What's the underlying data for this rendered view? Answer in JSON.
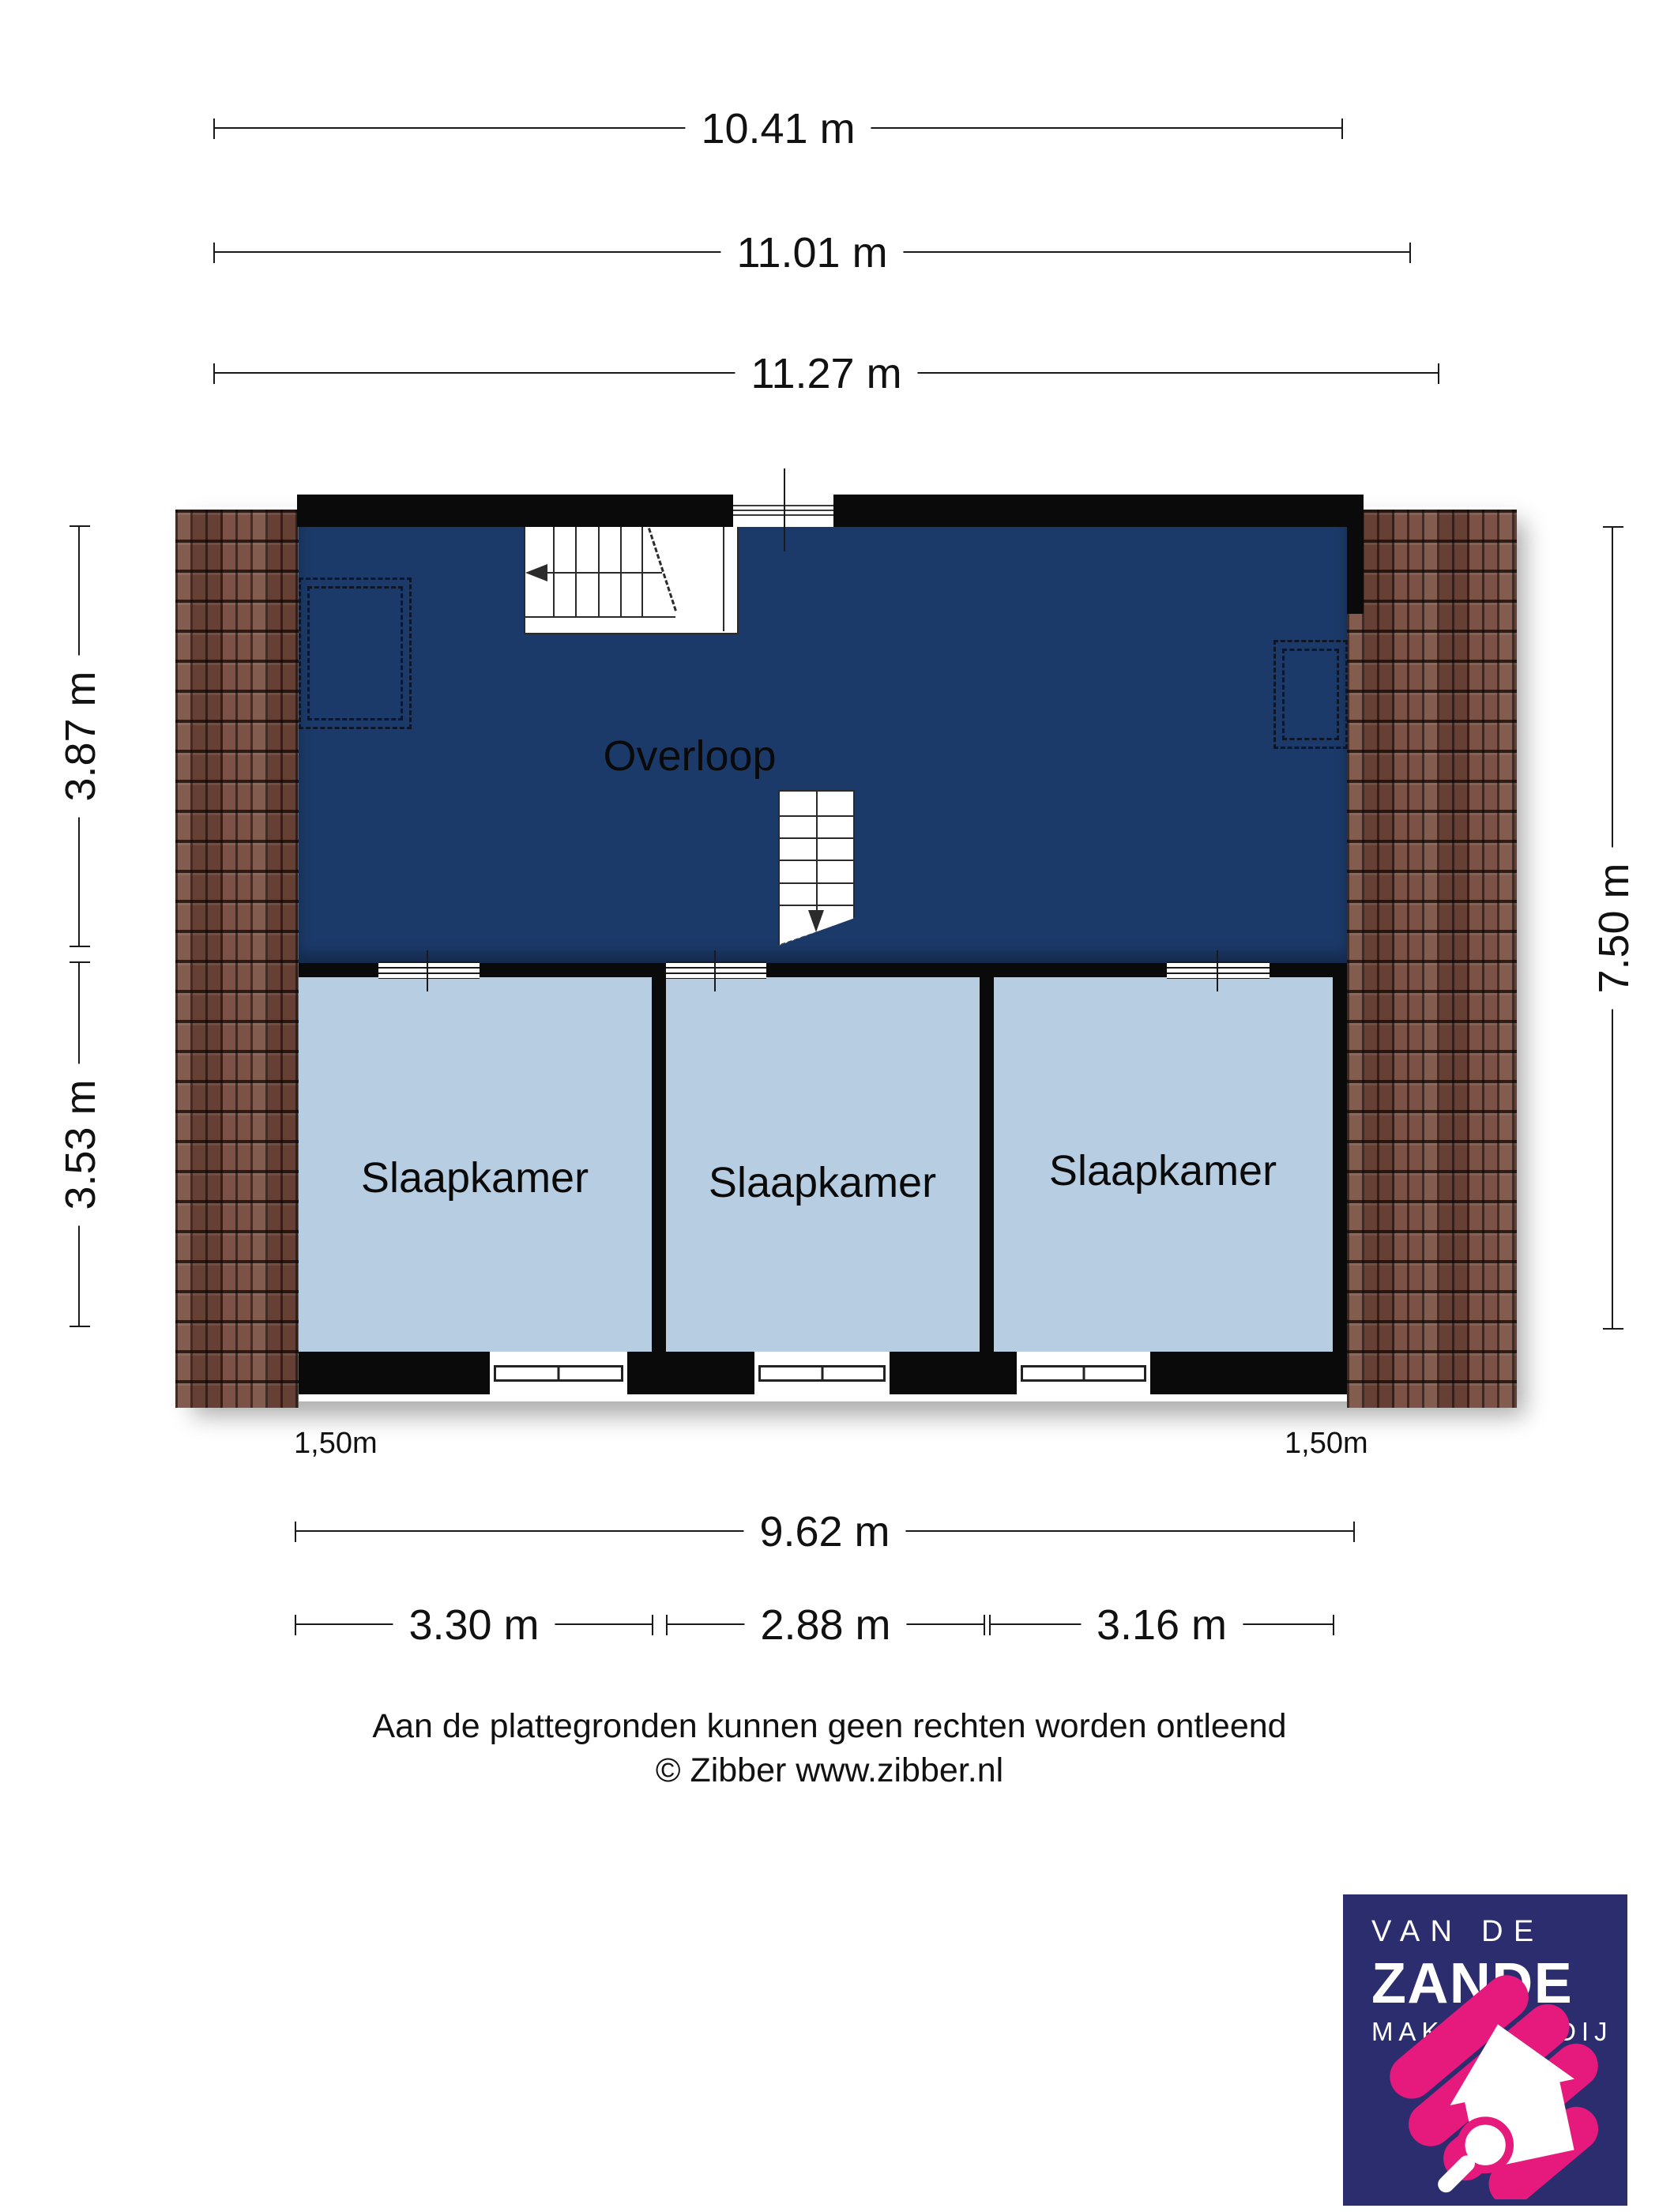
{
  "rooms": {
    "landing": "Overloop",
    "bedroom1": "Slaapkamer",
    "bedroom2": "Slaapkamer",
    "bedroom3": "Slaapkamer"
  },
  "dimensions": {
    "top": [
      "10.41 m",
      "11.01 m",
      "11.27 m"
    ],
    "left": [
      "3.87 m",
      "3.53 m"
    ],
    "right": [
      "7.50 m"
    ],
    "bottom_total": "9.62 m",
    "bottom_rooms": [
      "3.30 m",
      "2.88 m",
      "3.16 m"
    ],
    "headroom_left": "1,50m",
    "headroom_right": "1,50m"
  },
  "disclaimer": {
    "line1": "Aan de plattegronden kunnen geen rechten worden ontleend",
    "line2": "© Zibber www.zibber.nl"
  },
  "logo": {
    "line1": "VAN DE",
    "line2": "ZANDE",
    "line3": "MAKELAARDIJ"
  },
  "colors": {
    "navy": "#1c3a69",
    "room_blue": "#b7cde2",
    "wall_black": "#0a0a0a",
    "tile_brown": "#74493b",
    "logo_navy": "#2b2d6e",
    "brand_pink": "#e6197d"
  }
}
